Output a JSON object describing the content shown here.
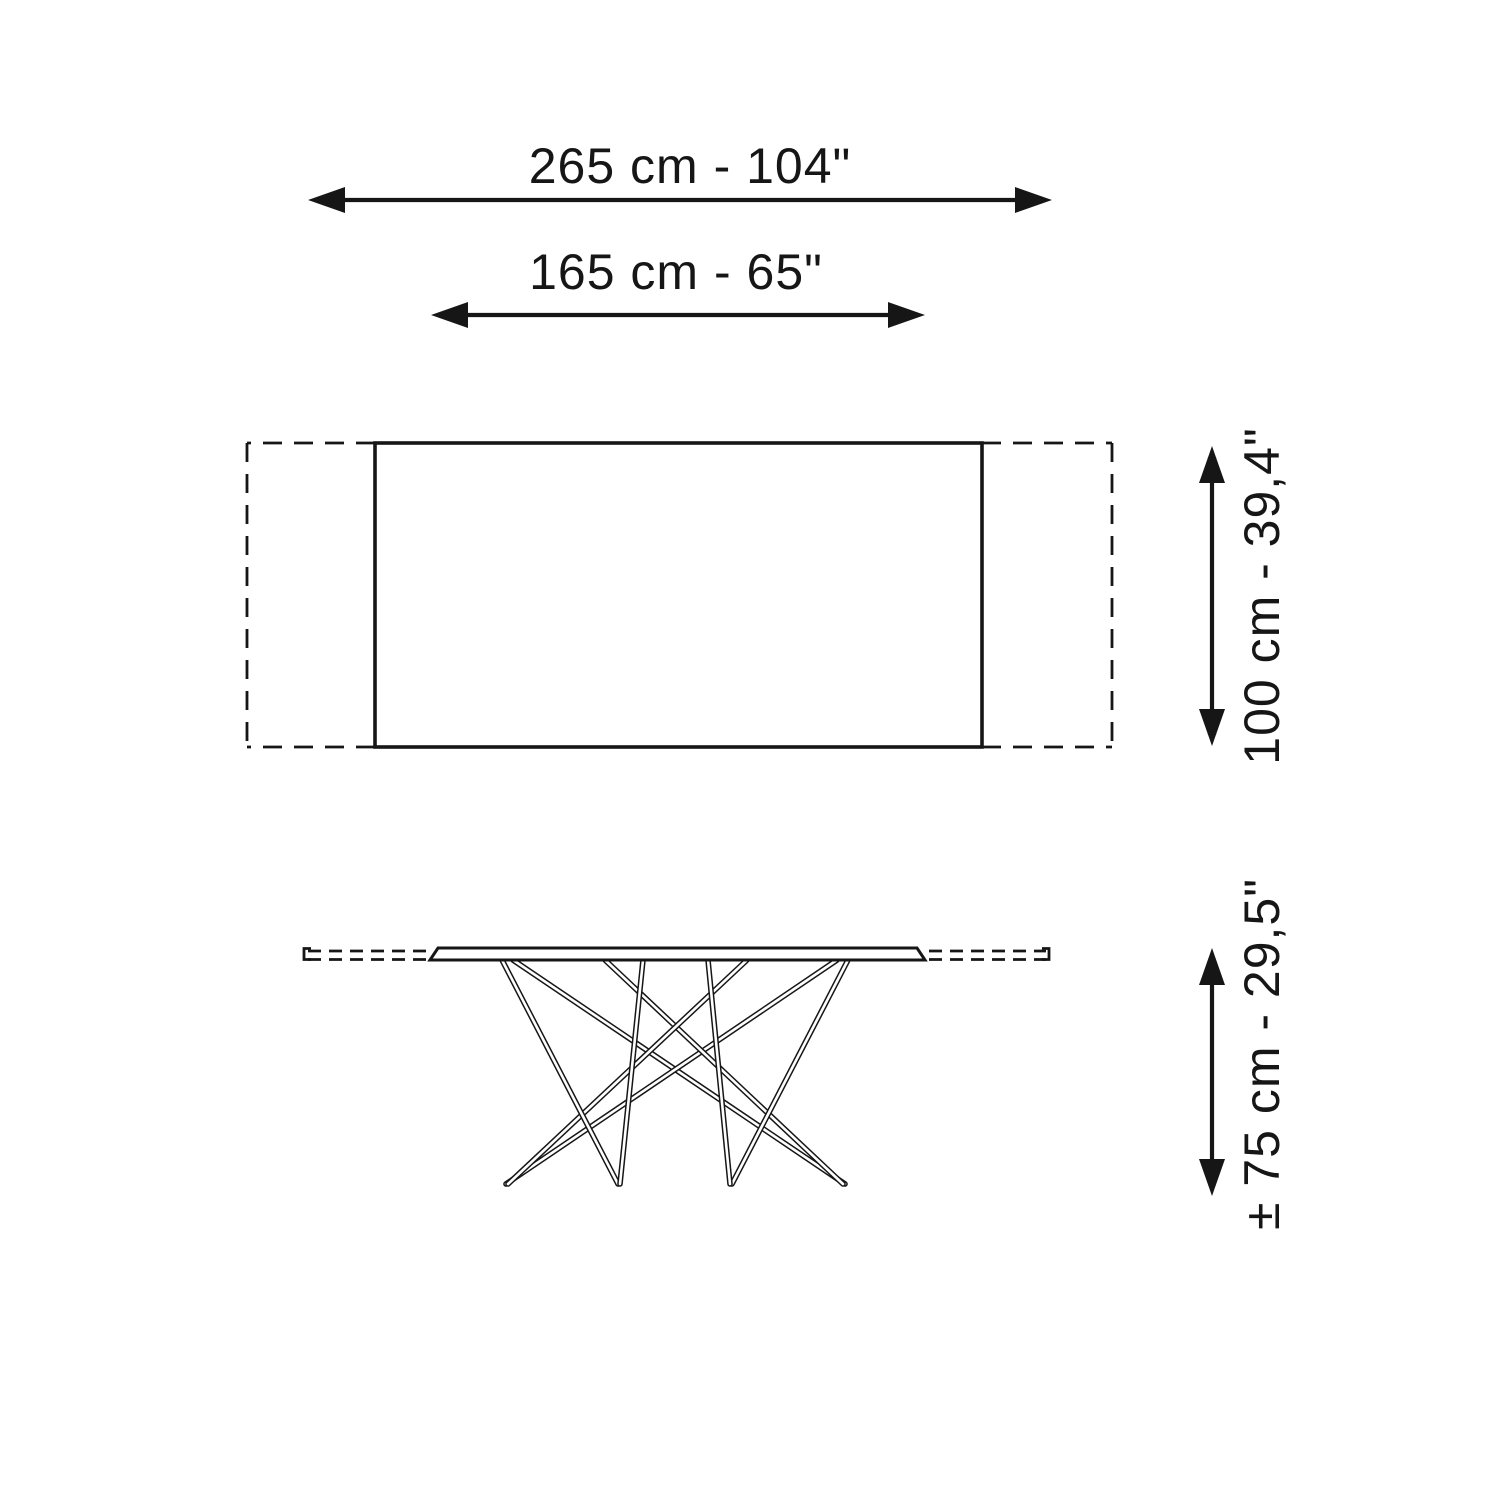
{
  "canvas": {
    "background": "#ffffff",
    "ink": "#161616"
  },
  "dimensions": {
    "extended_width": {
      "text": "265 cm - 104\"",
      "orientation": "horizontal"
    },
    "closed_width": {
      "text": "165 cm - 65\"",
      "orientation": "horizontal"
    },
    "depth": {
      "text": "100 cm - 39,4\"",
      "orientation": "vertical"
    },
    "height": {
      "text": "± 75 cm - 29,5\"",
      "orientation": "vertical"
    }
  }
}
